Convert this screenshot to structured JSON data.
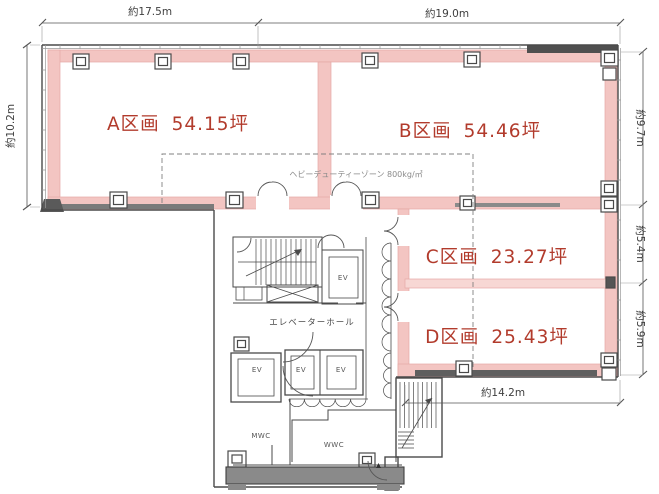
{
  "title": "office-floor-plan",
  "colors": {
    "wall": "#f3c5c2",
    "wall_light": "#f7d7d4",
    "zone_text": "#b23b2c",
    "line": "#4a4a4a",
    "dim_text": "#3f3f3f",
    "note_text": "#8a8a8a"
  },
  "dimensions": {
    "top_left": "約17.5m",
    "top_right": "約19.0m",
    "left": "約10.2m",
    "right_upper": "約9.7m",
    "right_middle": "約5.4m",
    "right_lower": "約5.9m",
    "bottom": "約14.2m"
  },
  "zones": [
    {
      "id": "A",
      "label": "A区画",
      "area": "54.15坪"
    },
    {
      "id": "B",
      "label": "B区画",
      "area": "54.46坪"
    },
    {
      "id": "C",
      "label": "C区画",
      "area": "23.27坪"
    },
    {
      "id": "D",
      "label": "D区画",
      "area": "25.43坪"
    }
  ],
  "annotations": {
    "heavy_duty_zone": "ヘビーデューティーゾーン 800kg/㎡",
    "elevator_hall": "エレベーターホール",
    "elevator": "EV",
    "mens_wc": "MWC",
    "womens_wc": "WWC"
  }
}
